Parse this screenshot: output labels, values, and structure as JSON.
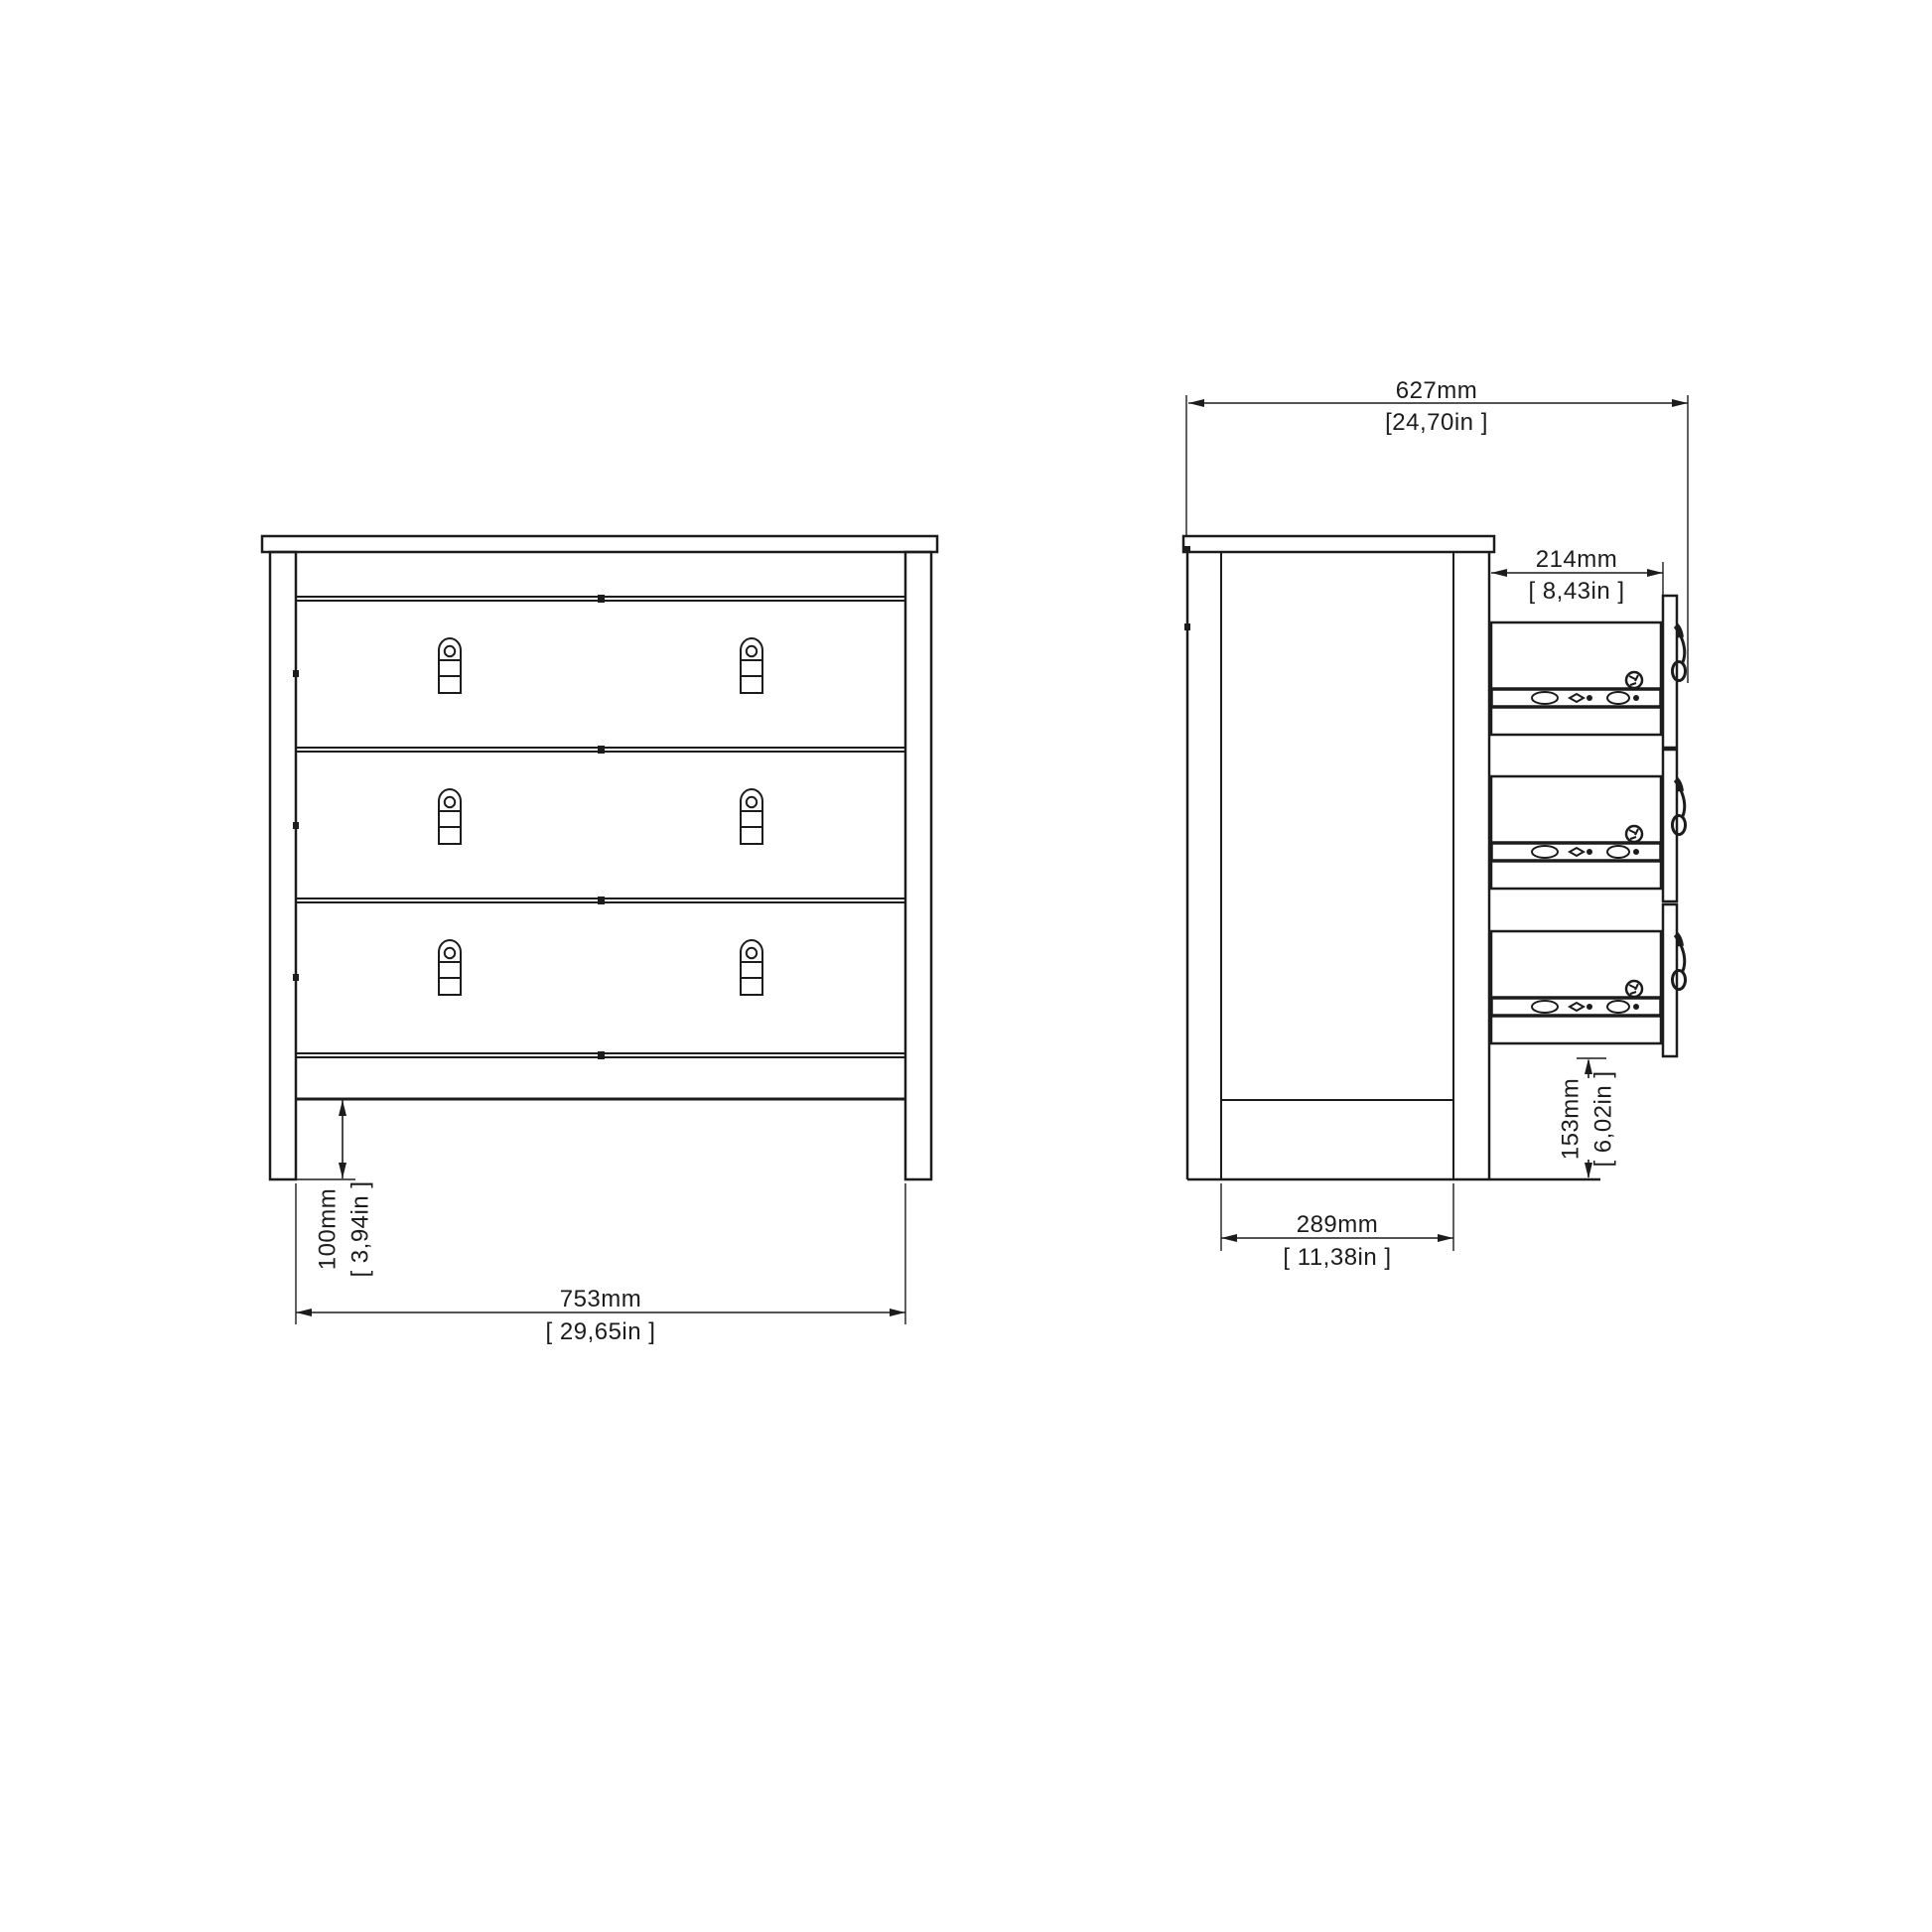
{
  "colors": {
    "background": "#ffffff",
    "line": "#1c1c1c"
  },
  "dimensions": {
    "overall_depth": {
      "metric": "627mm",
      "imperial": "[24,70in ]"
    },
    "drawer_side_depth": {
      "metric": "214mm",
      "imperial": "[ 8,43in ]"
    },
    "overall_width": {
      "metric": "753mm",
      "imperial": "[ 29,65in ]"
    },
    "plinth_height": {
      "metric": "100mm",
      "imperial": "[ 3,94in ]"
    },
    "inner_base_depth": {
      "metric": "289mm",
      "imperial": "[ 11,38in ]"
    },
    "drawer_front_height": {
      "metric": "153mm",
      "imperial": "[ 6,02in ]"
    }
  }
}
